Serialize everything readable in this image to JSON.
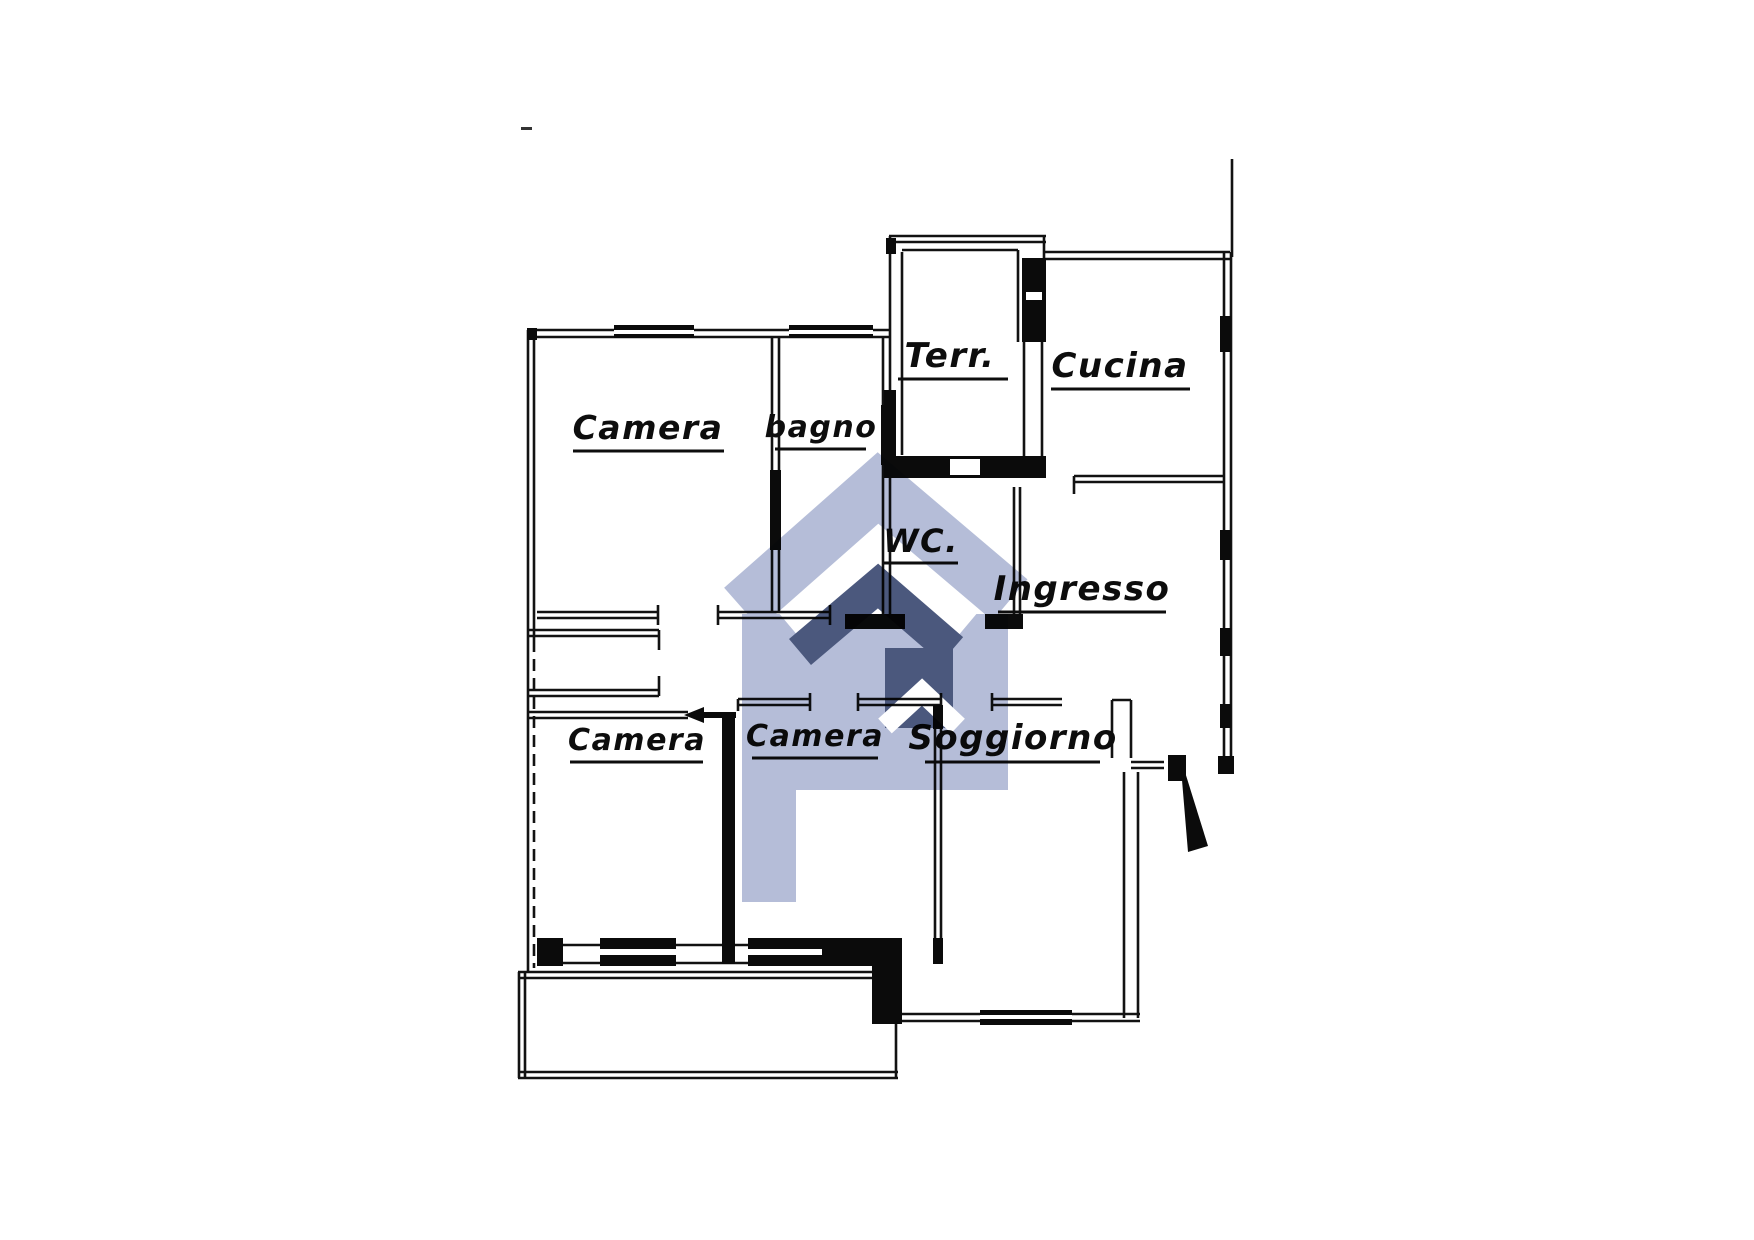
{
  "page": {
    "background": "#ffffff"
  },
  "plan": {
    "ink_color": "#111111",
    "rooms": [
      {
        "id": "terrazzo",
        "label": "Terr."
      },
      {
        "id": "cucina",
        "label": "Cucina"
      },
      {
        "id": "camera-top-left",
        "label": "Camera"
      },
      {
        "id": "bagno",
        "label": "bagno"
      },
      {
        "id": "wc",
        "label": "WC."
      },
      {
        "id": "ingresso",
        "label": "Ingresso"
      },
      {
        "id": "camera-bottom-left",
        "label": "Camera"
      },
      {
        "id": "camera-bottom-middle",
        "label": "Camera"
      },
      {
        "id": "soggiorno",
        "label": "Soggiorno"
      }
    ]
  },
  "watermark": {
    "light_color": "#a8b2d1",
    "dark_color": "#2b3a66"
  }
}
